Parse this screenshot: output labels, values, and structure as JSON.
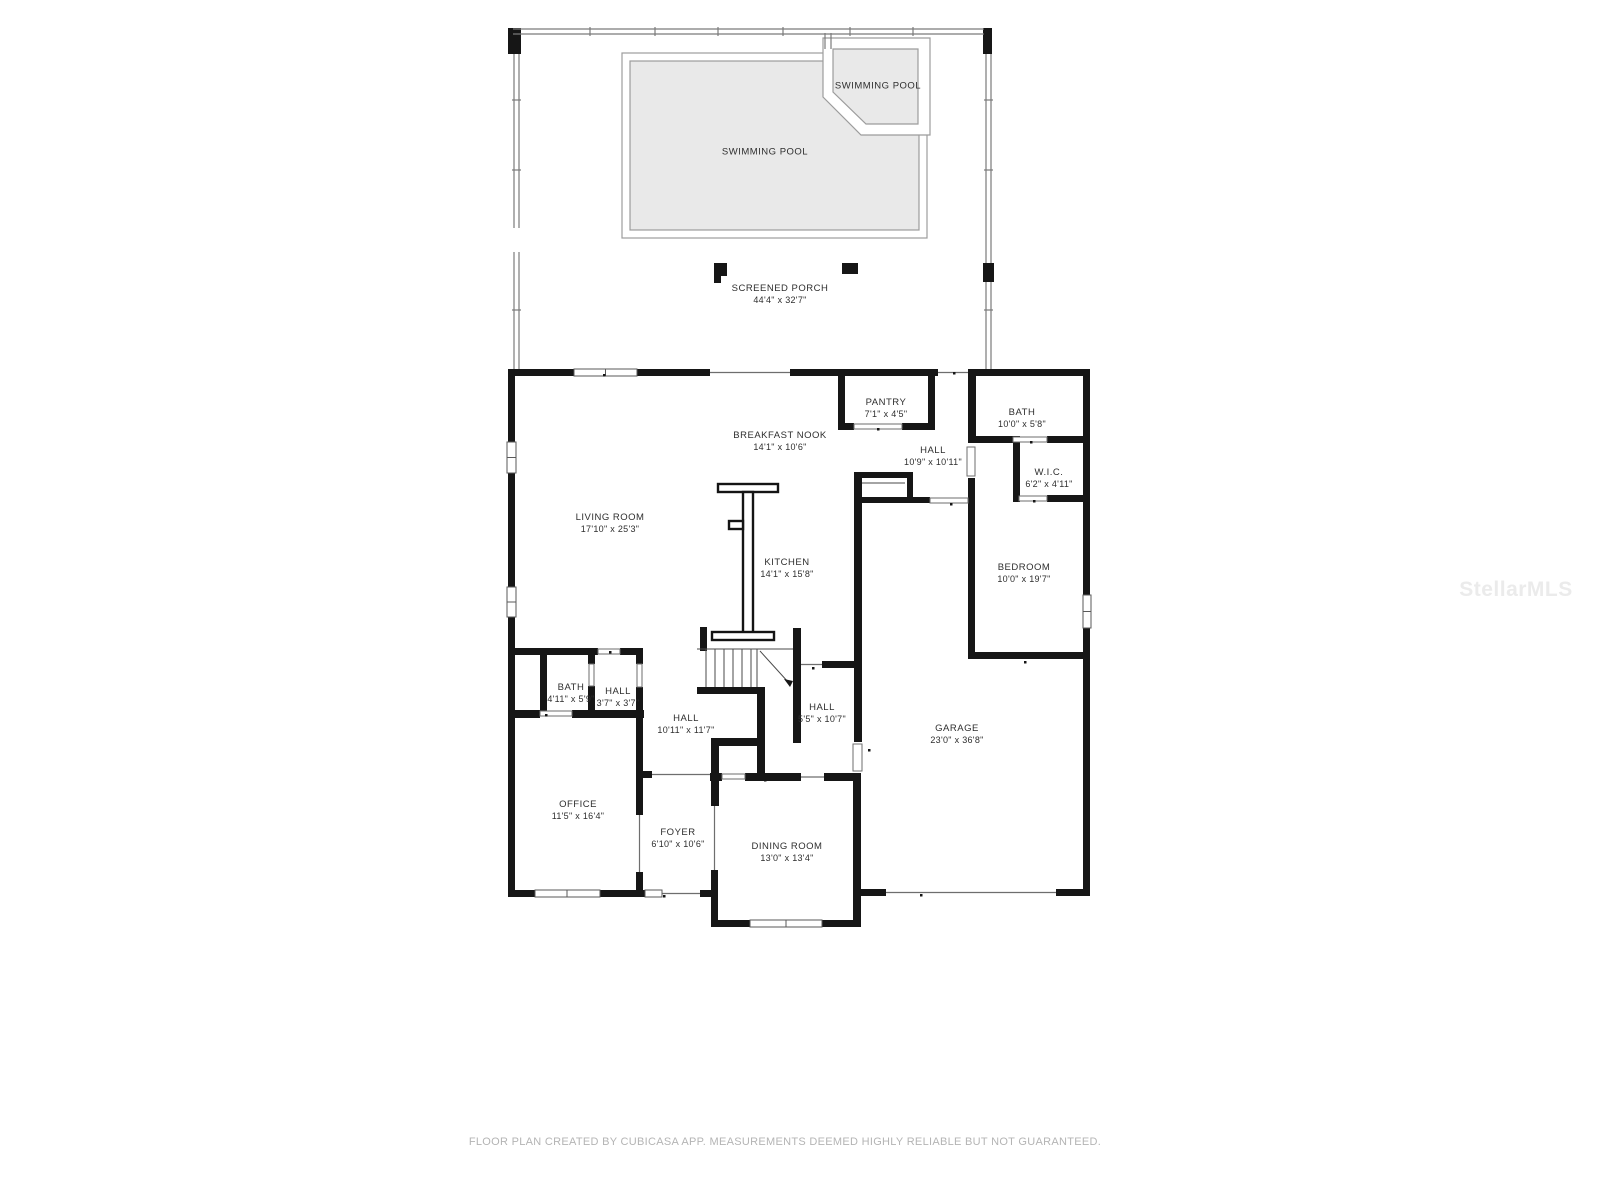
{
  "rooms": {
    "spa_pool": {
      "name": "SWIMMING POOL",
      "dims": ""
    },
    "main_pool": {
      "name": "SWIMMING POOL",
      "dims": ""
    },
    "screened_porch": {
      "name": "SCREENED PORCH",
      "dims": "44'4\" x 32'7\""
    },
    "breakfast_nook": {
      "name": "BREAKFAST NOOK",
      "dims": "14'1\" x 10'6\""
    },
    "living_room": {
      "name": "LIVING ROOM",
      "dims": "17'10\" x 25'3\""
    },
    "kitchen": {
      "name": "KITCHEN",
      "dims": "14'1\" x 15'8\""
    },
    "pantry": {
      "name": "PANTRY",
      "dims": "7'1\" x 4'5\""
    },
    "hall_upper": {
      "name": "HALL",
      "dims": "10'9\" x 10'11\""
    },
    "bath_upper": {
      "name": "BATH",
      "dims": "10'0\" x 5'8\""
    },
    "wic": {
      "name": "W.I.C.",
      "dims": "6'2\" x 4'11\""
    },
    "bedroom": {
      "name": "BEDROOM",
      "dims": "10'0\" x 19'7\""
    },
    "bath_lower": {
      "name": "BATH",
      "dims": "4'11\" x 5'9\""
    },
    "hall_small": {
      "name": "HALL",
      "dims": "3'7\" x 3'7\""
    },
    "hall_center": {
      "name": "HALL",
      "dims": "10'11\" x 11'7\""
    },
    "hall_right": {
      "name": "HALL",
      "dims": "5'5\" x 10'7\""
    },
    "garage": {
      "name": "GARAGE",
      "dims": "23'0\" x 36'8\""
    },
    "office": {
      "name": "OFFICE",
      "dims": "11'5\" x 16'4\""
    },
    "foyer": {
      "name": "FOYER",
      "dims": "6'10\" x 10'6\""
    },
    "dining_room": {
      "name": "DINING ROOM",
      "dims": "13'0\" x 13'4\""
    }
  },
  "footer": {
    "disclaimer": "FLOOR PLAN CREATED BY CUBICASA APP. MEASUREMENTS DEEMED HIGHLY RELIABLE BUT NOT GUARANTEED."
  },
  "watermark": {
    "text": "StellarMLS"
  },
  "colors": {
    "wall": "#161616",
    "pool_fill": "#e9e9e9",
    "pool_stroke": "#9c9c9c",
    "label_text": "#2e2e2e",
    "footer_text": "#b4b4b4",
    "watermark_text": "#ebebeb",
    "background": "#ffffff"
  }
}
